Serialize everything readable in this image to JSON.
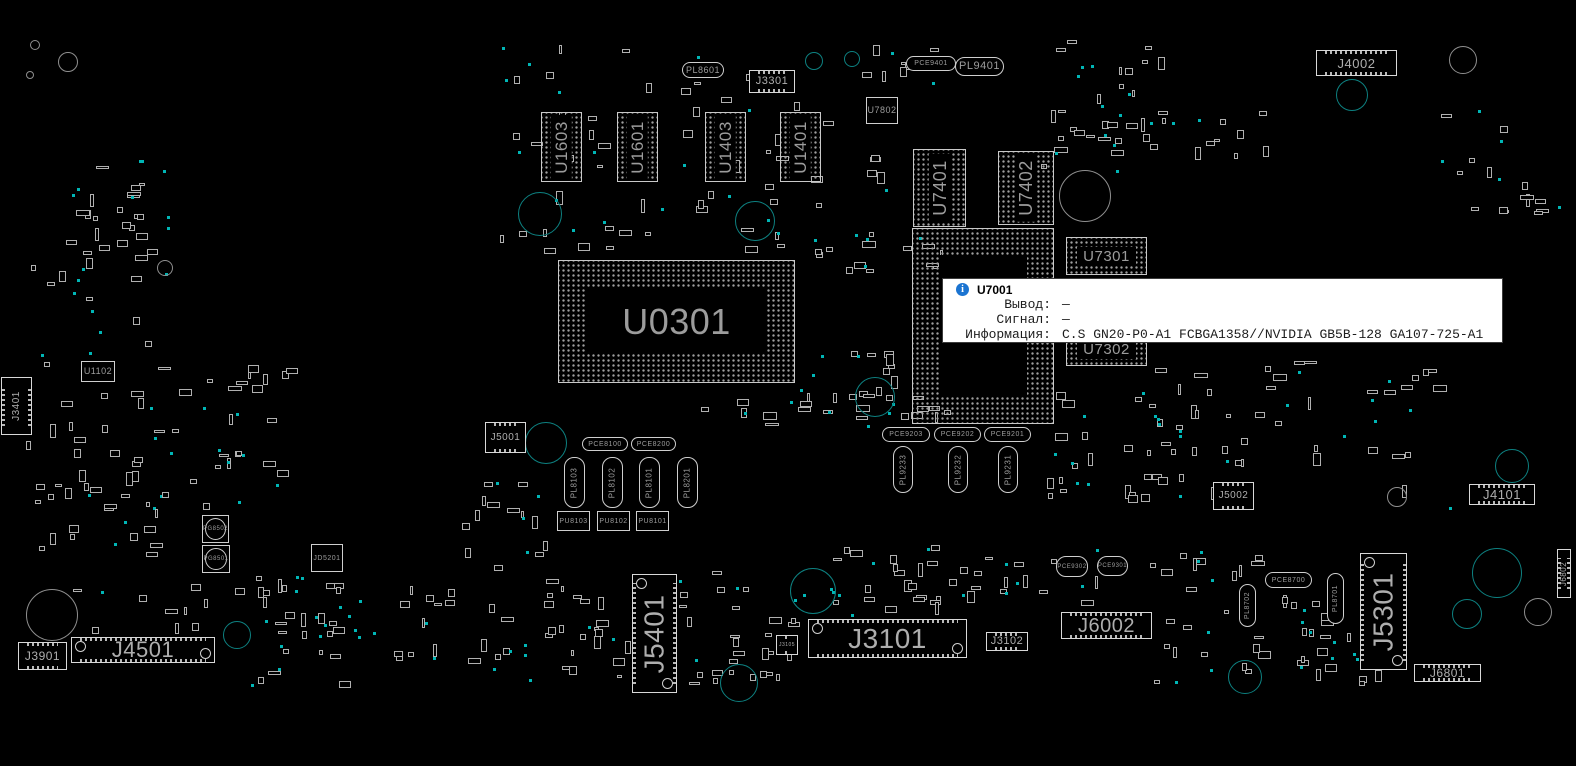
{
  "colors": {
    "background": "#000000",
    "outline": "#d6d6d6",
    "pad_dot": "#9f9f9f",
    "label": "#9c9c9c",
    "hole_teal": "#0d8181",
    "dot_teal": "#00b6b6",
    "hole_gray": "#8f8f8f",
    "tooltip_bg": "#ffffff",
    "tooltip_border": "#3c3c3c",
    "info_icon_blue": "#1b74d1"
  },
  "tooltip": {
    "component": "U7001",
    "title": "U7001",
    "icon": "info-icon",
    "rows": [
      {
        "label": "Вывод:",
        "value": "—"
      },
      {
        "label": "Сигнал:",
        "value": "—"
      },
      {
        "label": "Информация:",
        "value": "C.S GN20-P0-A1 FCBGA1358//NVIDIA GB5B-128 GA107-725-A1"
      }
    ]
  },
  "board": {
    "seed": 7,
    "components": [
      {
        "t": "bga",
        "l": "U0301",
        "x": 558,
        "y": 260,
        "w": 237,
        "h": 123,
        "fs": 36,
        "big": 28
      },
      {
        "t": "bga",
        "l": "U7001",
        "x": 912,
        "y": 228,
        "w": 142,
        "h": 196,
        "fs": 24,
        "big": 26
      },
      {
        "t": "bga",
        "l": "U1603",
        "x": 541,
        "y": 112,
        "w": 41,
        "h": 70,
        "fs": 17,
        "v": 1
      },
      {
        "t": "bga",
        "l": "U1601",
        "x": 617,
        "y": 112,
        "w": 41,
        "h": 70,
        "fs": 17,
        "v": 1
      },
      {
        "t": "bga",
        "l": "U1403",
        "x": 705,
        "y": 112,
        "w": 41,
        "h": 70,
        "fs": 17,
        "v": 1
      },
      {
        "t": "bga",
        "l": "U1401",
        "x": 780,
        "y": 112,
        "w": 41,
        "h": 70,
        "fs": 17,
        "v": 1
      },
      {
        "t": "bga",
        "l": "U7401",
        "x": 913,
        "y": 149,
        "w": 53,
        "h": 78,
        "fs": 18,
        "v": 1
      },
      {
        "t": "bga",
        "l": "U7402",
        "x": 998,
        "y": 151,
        "w": 56,
        "h": 74,
        "fs": 18,
        "v": 1
      },
      {
        "t": "bga",
        "l": "U7301",
        "x": 1066,
        "y": 237,
        "w": 81,
        "h": 38,
        "fs": 15
      },
      {
        "t": "bga",
        "l": "U7302",
        "x": 1066,
        "y": 333,
        "w": 81,
        "h": 33,
        "fs": 15
      },
      {
        "t": "chip",
        "l": "U1102",
        "x": 81,
        "y": 361,
        "w": 34,
        "h": 21,
        "fs": 9
      },
      {
        "t": "chip",
        "l": "U7802",
        "x": 866,
        "y": 97,
        "w": 32,
        "h": 27,
        "fs": 9
      },
      {
        "t": "chip",
        "l": "PU8103",
        "x": 557,
        "y": 511,
        "w": 33,
        "h": 20,
        "fs": 7
      },
      {
        "t": "chip",
        "l": "PU8102",
        "x": 597,
        "y": 511,
        "w": 33,
        "h": 20,
        "fs": 7
      },
      {
        "t": "chip",
        "l": "PU8101",
        "x": 636,
        "y": 511,
        "w": 33,
        "h": 20,
        "fs": 7
      },
      {
        "t": "chip",
        "l": "JD5201",
        "x": 311,
        "y": 544,
        "w": 32,
        "h": 28,
        "fs": 7
      },
      {
        "t": "conn",
        "l": "J4002",
        "x": 1316,
        "y": 50,
        "w": 81,
        "h": 26,
        "fs": 13
      },
      {
        "t": "conn",
        "l": "J3301",
        "x": 749,
        "y": 70,
        "w": 46,
        "h": 23,
        "fs": 11
      },
      {
        "t": "conn",
        "l": "J3401",
        "x": 1,
        "y": 377,
        "w": 31,
        "h": 58,
        "fs": 10,
        "v": 1
      },
      {
        "t": "conn",
        "l": "J5001",
        "x": 485,
        "y": 422,
        "w": 41,
        "h": 31,
        "fs": 10
      },
      {
        "t": "conn",
        "l": "J5002",
        "x": 1213,
        "y": 482,
        "w": 41,
        "h": 28,
        "fs": 10
      },
      {
        "t": "conn",
        "l": "J3901",
        "x": 18,
        "y": 642,
        "w": 49,
        "h": 28,
        "fs": 12
      },
      {
        "t": "conn",
        "l": "J4501",
        "x": 71,
        "y": 637,
        "w": 144,
        "h": 26,
        "fs": 22,
        "bigc": 1
      },
      {
        "t": "conn",
        "l": "J5401",
        "x": 632,
        "y": 574,
        "w": 45,
        "h": 119,
        "fs": 28,
        "v": 1,
        "bigc": 1
      },
      {
        "t": "conn",
        "l": "J3105",
        "x": 776,
        "y": 635,
        "w": 22,
        "h": 20,
        "fs": 5
      },
      {
        "t": "conn",
        "l": "J3101",
        "x": 808,
        "y": 619,
        "w": 159,
        "h": 39,
        "fs": 28,
        "bigc": 1
      },
      {
        "t": "conn",
        "l": "J3102",
        "x": 986,
        "y": 632,
        "w": 42,
        "h": 19,
        "fs": 11
      },
      {
        "t": "conn",
        "l": "J6002",
        "x": 1061,
        "y": 612,
        "w": 91,
        "h": 27,
        "fs": 20
      },
      {
        "t": "conn",
        "l": "J4101",
        "x": 1469,
        "y": 484,
        "w": 66,
        "h": 21,
        "fs": 13
      },
      {
        "t": "conn",
        "l": "J5301",
        "x": 1360,
        "y": 553,
        "w": 47,
        "h": 117,
        "fs": 28,
        "v": 1,
        "bigc": 1
      },
      {
        "t": "conn",
        "l": "J6801",
        "x": 1414,
        "y": 664,
        "w": 67,
        "h": 18,
        "fs": 12
      },
      {
        "t": "conn",
        "l": "J6802",
        "x": 1557,
        "y": 549,
        "w": 14,
        "h": 49,
        "fs": 8,
        "v": 1
      },
      {
        "t": "oval",
        "l": "PL8601",
        "x": 682,
        "y": 62,
        "w": 42,
        "h": 16,
        "fs": 9
      },
      {
        "t": "oval",
        "l": "PCE9401",
        "x": 906,
        "y": 56,
        "w": 50,
        "h": 15,
        "fs": 7
      },
      {
        "t": "oval",
        "l": "PL9401",
        "x": 955,
        "y": 57,
        "w": 49,
        "h": 19,
        "fs": 11
      },
      {
        "t": "oval",
        "l": "PCE8100",
        "x": 582,
        "y": 437,
        "w": 46,
        "h": 14,
        "fs": 7
      },
      {
        "t": "oval",
        "l": "PCE8200",
        "x": 631,
        "y": 437,
        "w": 45,
        "h": 14,
        "fs": 7
      },
      {
        "t": "oval",
        "l": "PL8103",
        "x": 564,
        "y": 457,
        "w": 21,
        "h": 51,
        "fs": 8,
        "v": 1
      },
      {
        "t": "oval",
        "l": "PL8102",
        "x": 602,
        "y": 457,
        "w": 21,
        "h": 51,
        "fs": 8,
        "v": 1
      },
      {
        "t": "oval",
        "l": "PL8101",
        "x": 639,
        "y": 457,
        "w": 21,
        "h": 51,
        "fs": 8,
        "v": 1
      },
      {
        "t": "oval",
        "l": "PL8201",
        "x": 677,
        "y": 457,
        "w": 21,
        "h": 51,
        "fs": 8,
        "v": 1
      },
      {
        "t": "oval",
        "l": "PCE9203",
        "x": 882,
        "y": 427,
        "w": 48,
        "h": 15,
        "fs": 7
      },
      {
        "t": "oval",
        "l": "PCE9202",
        "x": 934,
        "y": 427,
        "w": 47,
        "h": 15,
        "fs": 7
      },
      {
        "t": "oval",
        "l": "PCE9201",
        "x": 984,
        "y": 427,
        "w": 47,
        "h": 15,
        "fs": 7
      },
      {
        "t": "oval",
        "l": "PL9233",
        "x": 893,
        "y": 446,
        "w": 20,
        "h": 47,
        "fs": 8,
        "v": 1
      },
      {
        "t": "oval",
        "l": "PL9232",
        "x": 948,
        "y": 446,
        "w": 20,
        "h": 47,
        "fs": 8,
        "v": 1
      },
      {
        "t": "oval",
        "l": "PL9231",
        "x": 998,
        "y": 446,
        "w": 20,
        "h": 47,
        "fs": 8,
        "v": 1
      },
      {
        "t": "oval",
        "l": "PCE8700",
        "x": 1265,
        "y": 572,
        "w": 47,
        "h": 16,
        "fs": 7
      },
      {
        "t": "oval",
        "l": "PL8702",
        "x": 1239,
        "y": 584,
        "w": 17,
        "h": 43,
        "fs": 7,
        "v": 1
      },
      {
        "t": "oval",
        "l": "PL8701",
        "x": 1327,
        "y": 573,
        "w": 17,
        "h": 51,
        "fs": 7,
        "v": 1
      },
      {
        "t": "oval",
        "l": "PCE9302",
        "x": 1056,
        "y": 556,
        "w": 32,
        "h": 21,
        "fs": 6
      },
      {
        "t": "oval",
        "l": "PCE9301",
        "x": 1097,
        "y": 556,
        "w": 31,
        "h": 20,
        "fs": 6
      },
      {
        "t": "pgc",
        "l": "PG8502",
        "x": 202,
        "y": 515,
        "w": 27,
        "h": 28,
        "fs": 6
      },
      {
        "t": "pgc",
        "l": "PG8501",
        "x": 202,
        "y": 545,
        "w": 28,
        "h": 28,
        "fs": 6
      }
    ],
    "holes": [
      [
        546,
        443,
        21,
        "t"
      ],
      [
        813,
        591,
        23,
        "t"
      ],
      [
        739,
        683,
        19,
        "t"
      ],
      [
        1497,
        573,
        25,
        "t"
      ],
      [
        1467,
        614,
        15,
        "t"
      ],
      [
        237,
        635,
        14,
        "t"
      ],
      [
        540,
        214,
        22,
        "t"
      ],
      [
        755,
        221,
        20,
        "t"
      ],
      [
        875,
        397,
        20,
        "t"
      ],
      [
        1352,
        95,
        16,
        "t"
      ],
      [
        1245,
        677,
        17,
        "t"
      ],
      [
        814,
        61,
        9,
        "t"
      ],
      [
        852,
        59,
        8,
        "t"
      ],
      [
        1512,
        466,
        17,
        "t"
      ],
      [
        1463,
        60,
        14,
        "g"
      ],
      [
        1397,
        497,
        10,
        "g"
      ],
      [
        1538,
        612,
        14,
        "g"
      ],
      [
        1085,
        196,
        26,
        "g"
      ],
      [
        52,
        615,
        26,
        "g"
      ],
      [
        165,
        268,
        8,
        "g"
      ],
      [
        68,
        62,
        10,
        "g"
      ],
      [
        35,
        45,
        5,
        "g"
      ],
      [
        30,
        75,
        4,
        "g"
      ]
    ],
    "noise_zones": [
      [
        490,
        40,
        400,
        215,
        55
      ],
      [
        60,
        160,
        110,
        110,
        22
      ],
      [
        25,
        250,
        140,
        310,
        40
      ],
      [
        795,
        230,
        150,
        45,
        12
      ],
      [
        800,
        345,
        160,
        75,
        18
      ],
      [
        700,
        390,
        240,
        40,
        15
      ],
      [
        1040,
        390,
        160,
        120,
        25
      ],
      [
        250,
        560,
        560,
        130,
        60
      ],
      [
        820,
        545,
        280,
        70,
        35
      ],
      [
        1150,
        360,
        300,
        150,
        35
      ],
      [
        1040,
        40,
        130,
        130,
        25
      ],
      [
        1440,
        80,
        120,
        150,
        14
      ],
      [
        60,
        580,
        380,
        55,
        22
      ],
      [
        1150,
        550,
        160,
        140,
        25
      ],
      [
        855,
        45,
        90,
        45,
        8
      ],
      [
        130,
        360,
        170,
        160,
        30
      ],
      [
        440,
        480,
        120,
        80,
        12
      ],
      [
        1290,
        600,
        120,
        90,
        18
      ],
      [
        1100,
        100,
        200,
        60,
        12
      ],
      [
        480,
        600,
        330,
        90,
        28
      ]
    ]
  }
}
